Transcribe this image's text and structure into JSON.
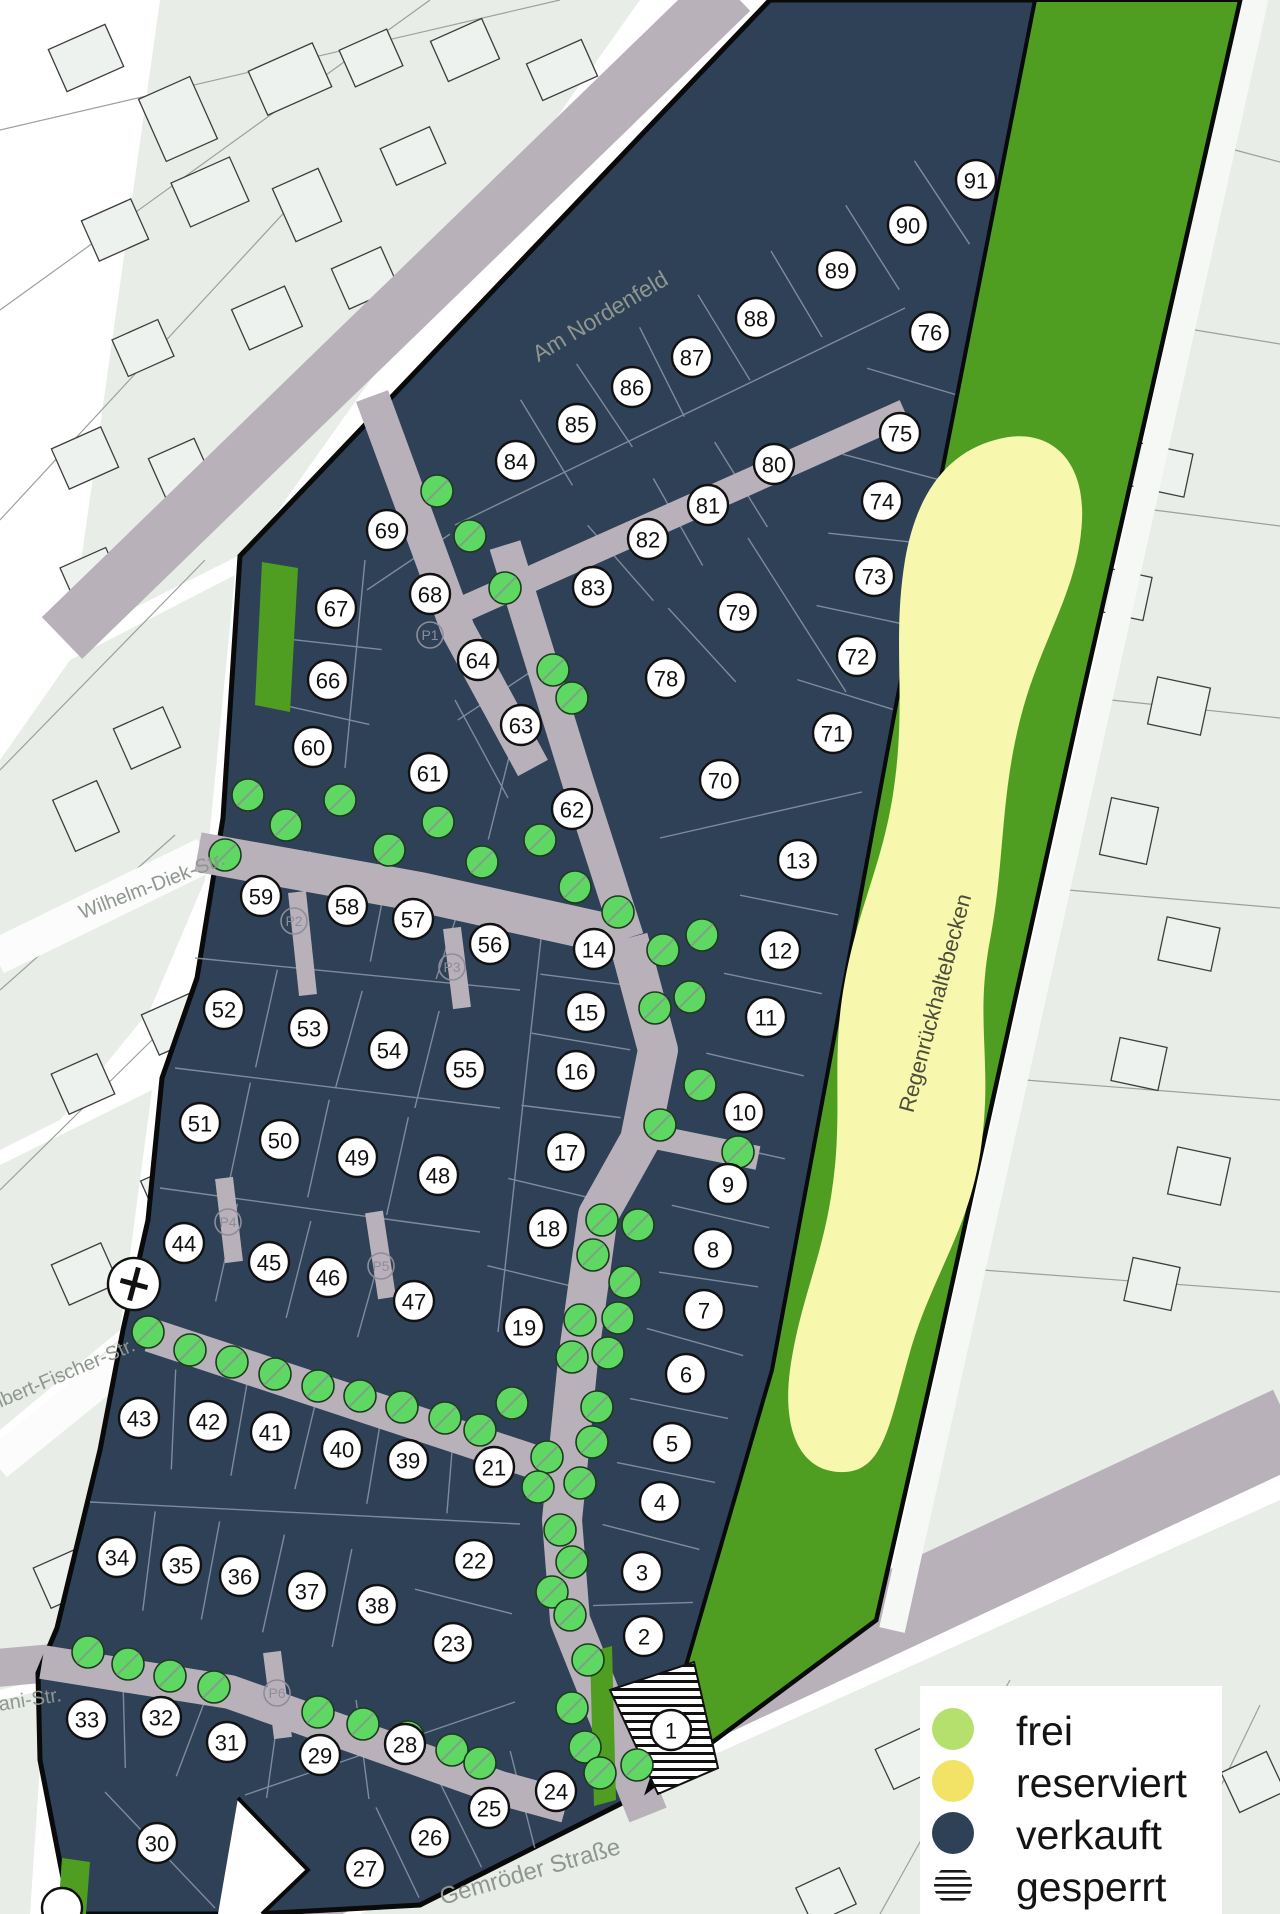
{
  "title": "Baugebiet Lageplan",
  "colors": {
    "sold": "#2e4156",
    "free": "#b5e06e",
    "reserved": "#f2e366",
    "blocked_stripes": "#111111",
    "green_area": "#4f9e22",
    "basin_yellow": "#f7f8ad",
    "street": "#b9b1ba",
    "tree": "#5fd763",
    "background_parcel": "#e8ede7",
    "boundary": "#0a0a0a"
  },
  "legend": {
    "items": [
      {
        "label": "frei",
        "swatch": "frei",
        "color": "#b5e06e"
      },
      {
        "label": "reserviert",
        "swatch": "reserviert",
        "color": "#f2e366"
      },
      {
        "label": "verkauft",
        "swatch": "verkauft",
        "color": "#2e4156"
      },
      {
        "label": "gesperrt",
        "swatch": "gesperrt",
        "color": "striped"
      }
    ]
  },
  "street_labels": [
    {
      "text": "Am Nordenfeld",
      "x": 600,
      "y": 316,
      "rot": -31,
      "size": 23
    },
    {
      "text": "Wilhelm-Diek-Str.",
      "x": 152,
      "y": 886,
      "rot": -21,
      "size": 20
    },
    {
      "text": "Albert-Fischer-Str.",
      "x": 60,
      "y": 1376,
      "rot": -23,
      "size": 20
    },
    {
      "text": "ani-Str.",
      "x": 30,
      "y": 1700,
      "rot": -9,
      "size": 20
    },
    {
      "text": "Gemröder Straße",
      "x": 530,
      "y": 1872,
      "rot": -16,
      "size": 24
    }
  ],
  "area_labels": [
    {
      "text": "Regenrückhaltebecken",
      "x": 935,
      "y": 1003,
      "rot": -75,
      "size": 22
    }
  ],
  "plots": [
    {
      "n": "91",
      "x": 976,
      "y": 180,
      "status": "verkauft"
    },
    {
      "n": "90",
      "x": 908,
      "y": 225,
      "status": "verkauft"
    },
    {
      "n": "89",
      "x": 837,
      "y": 270,
      "status": "verkauft"
    },
    {
      "n": "88",
      "x": 756,
      "y": 318,
      "status": "verkauft"
    },
    {
      "n": "87",
      "x": 692,
      "y": 357,
      "status": "verkauft"
    },
    {
      "n": "86",
      "x": 632,
      "y": 387,
      "status": "verkauft"
    },
    {
      "n": "85",
      "x": 577,
      "y": 424,
      "status": "verkauft"
    },
    {
      "n": "84",
      "x": 516,
      "y": 461,
      "status": "verkauft"
    },
    {
      "n": "76",
      "x": 930,
      "y": 332,
      "status": "verkauft"
    },
    {
      "n": "75",
      "x": 900,
      "y": 433,
      "status": "verkauft"
    },
    {
      "n": "74",
      "x": 882,
      "y": 501,
      "status": "verkauft"
    },
    {
      "n": "73",
      "x": 874,
      "y": 576,
      "status": "verkauft"
    },
    {
      "n": "72",
      "x": 857,
      "y": 656,
      "status": "verkauft"
    },
    {
      "n": "71",
      "x": 833,
      "y": 733,
      "status": "verkauft"
    },
    {
      "n": "80",
      "x": 774,
      "y": 464,
      "status": "verkauft"
    },
    {
      "n": "81",
      "x": 708,
      "y": 505,
      "status": "verkauft"
    },
    {
      "n": "82",
      "x": 648,
      "y": 539,
      "status": "verkauft"
    },
    {
      "n": "83",
      "x": 593,
      "y": 587,
      "status": "verkauft"
    },
    {
      "n": "79",
      "x": 738,
      "y": 612,
      "status": "verkauft"
    },
    {
      "n": "78",
      "x": 666,
      "y": 678,
      "status": "verkauft"
    },
    {
      "n": "70",
      "x": 720,
      "y": 780,
      "status": "verkauft"
    },
    {
      "n": "69",
      "x": 387,
      "y": 530,
      "status": "verkauft"
    },
    {
      "n": "68",
      "x": 430,
      "y": 594,
      "status": "verkauft"
    },
    {
      "n": "67",
      "x": 336,
      "y": 608,
      "status": "verkauft"
    },
    {
      "n": "66",
      "x": 328,
      "y": 680,
      "status": "verkauft"
    },
    {
      "n": "64",
      "x": 478,
      "y": 660,
      "status": "verkauft"
    },
    {
      "n": "63",
      "x": 521,
      "y": 725,
      "status": "verkauft"
    },
    {
      "n": "60",
      "x": 313,
      "y": 747,
      "status": "verkauft"
    },
    {
      "n": "61",
      "x": 429,
      "y": 773,
      "status": "verkauft"
    },
    {
      "n": "62",
      "x": 572,
      "y": 809,
      "status": "verkauft"
    },
    {
      "n": "13",
      "x": 798,
      "y": 860,
      "status": "verkauft"
    },
    {
      "n": "12",
      "x": 780,
      "y": 950,
      "status": "verkauft"
    },
    {
      "n": "11",
      "x": 766,
      "y": 1017,
      "status": "verkauft"
    },
    {
      "n": "59",
      "x": 261,
      "y": 896,
      "status": "verkauft"
    },
    {
      "n": "58",
      "x": 347,
      "y": 906,
      "status": "verkauft"
    },
    {
      "n": "57",
      "x": 413,
      "y": 919,
      "status": "verkauft"
    },
    {
      "n": "56",
      "x": 490,
      "y": 944,
      "status": "verkauft"
    },
    {
      "n": "14",
      "x": 594,
      "y": 949,
      "status": "verkauft"
    },
    {
      "n": "15",
      "x": 586,
      "y": 1012,
      "status": "verkauft"
    },
    {
      "n": "16",
      "x": 576,
      "y": 1071,
      "status": "verkauft"
    },
    {
      "n": "10",
      "x": 744,
      "y": 1112,
      "status": "verkauft"
    },
    {
      "n": "52",
      "x": 224,
      "y": 1009,
      "status": "verkauft"
    },
    {
      "n": "53",
      "x": 309,
      "y": 1028,
      "status": "verkauft"
    },
    {
      "n": "54",
      "x": 389,
      "y": 1050,
      "status": "verkauft"
    },
    {
      "n": "55",
      "x": 465,
      "y": 1069,
      "status": "verkauft"
    },
    {
      "n": "51",
      "x": 200,
      "y": 1123,
      "status": "verkauft"
    },
    {
      "n": "50",
      "x": 280,
      "y": 1140,
      "status": "verkauft"
    },
    {
      "n": "49",
      "x": 357,
      "y": 1157,
      "status": "verkauft"
    },
    {
      "n": "48",
      "x": 438,
      "y": 1175,
      "status": "verkauft"
    },
    {
      "n": "17",
      "x": 566,
      "y": 1152,
      "status": "verkauft"
    },
    {
      "n": "18",
      "x": 548,
      "y": 1228,
      "status": "verkauft"
    },
    {
      "n": "9",
      "x": 728,
      "y": 1184,
      "status": "verkauft"
    },
    {
      "n": "8",
      "x": 713,
      "y": 1249,
      "status": "verkauft"
    },
    {
      "n": "7",
      "x": 704,
      "y": 1310,
      "status": "verkauft"
    },
    {
      "n": "44",
      "x": 184,
      "y": 1243,
      "status": "verkauft"
    },
    {
      "n": "45",
      "x": 269,
      "y": 1262,
      "status": "verkauft"
    },
    {
      "n": "46",
      "x": 328,
      "y": 1277,
      "status": "verkauft"
    },
    {
      "n": "47",
      "x": 414,
      "y": 1301,
      "status": "verkauft"
    },
    {
      "n": "19",
      "x": 524,
      "y": 1327,
      "status": "verkauft"
    },
    {
      "n": "6",
      "x": 686,
      "y": 1374,
      "status": "verkauft"
    },
    {
      "n": "43",
      "x": 139,
      "y": 1418,
      "status": "verkauft"
    },
    {
      "n": "42",
      "x": 208,
      "y": 1421,
      "status": "verkauft"
    },
    {
      "n": "41",
      "x": 271,
      "y": 1432,
      "status": "verkauft"
    },
    {
      "n": "40",
      "x": 342,
      "y": 1449,
      "status": "verkauft"
    },
    {
      "n": "39",
      "x": 408,
      "y": 1460,
      "status": "verkauft"
    },
    {
      "n": "21",
      "x": 494,
      "y": 1467,
      "status": "verkauft"
    },
    {
      "n": "5",
      "x": 672,
      "y": 1443,
      "status": "verkauft"
    },
    {
      "n": "4",
      "x": 660,
      "y": 1502,
      "status": "verkauft"
    },
    {
      "n": "34",
      "x": 117,
      "y": 1557,
      "status": "verkauft"
    },
    {
      "n": "35",
      "x": 181,
      "y": 1565,
      "status": "verkauft"
    },
    {
      "n": "36",
      "x": 240,
      "y": 1576,
      "status": "verkauft"
    },
    {
      "n": "37",
      "x": 307,
      "y": 1591,
      "status": "verkauft"
    },
    {
      "n": "38",
      "x": 377,
      "y": 1605,
      "status": "verkauft"
    },
    {
      "n": "22",
      "x": 474,
      "y": 1560,
      "status": "verkauft"
    },
    {
      "n": "3",
      "x": 642,
      "y": 1572,
      "status": "verkauft"
    },
    {
      "n": "23",
      "x": 453,
      "y": 1643,
      "status": "verkauft"
    },
    {
      "n": "2",
      "x": 644,
      "y": 1636,
      "status": "verkauft"
    },
    {
      "n": "33",
      "x": 87,
      "y": 1719,
      "status": "verkauft"
    },
    {
      "n": "32",
      "x": 161,
      "y": 1717,
      "status": "verkauft"
    },
    {
      "n": "31",
      "x": 227,
      "y": 1742,
      "status": "verkauft"
    },
    {
      "n": "29",
      "x": 320,
      "y": 1755,
      "status": "verkauft"
    },
    {
      "n": "28",
      "x": 405,
      "y": 1744,
      "status": "verkauft"
    },
    {
      "n": "24",
      "x": 556,
      "y": 1791,
      "status": "verkauft"
    },
    {
      "n": "1",
      "x": 671,
      "y": 1730,
      "status": "gesperrt"
    },
    {
      "n": "30",
      "x": 157,
      "y": 1843,
      "status": "verkauft"
    },
    {
      "n": "25",
      "x": 489,
      "y": 1808,
      "status": "verkauft"
    },
    {
      "n": "26",
      "x": 430,
      "y": 1837,
      "status": "verkauft"
    },
    {
      "n": "27",
      "x": 365,
      "y": 1868,
      "status": "verkauft"
    }
  ],
  "partial_badges": [
    {
      "x": 62,
      "y": 1908
    }
  ],
  "parking": [
    {
      "label": "P1",
      "x": 430,
      "y": 635
    },
    {
      "label": "P2",
      "x": 294,
      "y": 921
    },
    {
      "label": "P3",
      "x": 452,
      "y": 967
    },
    {
      "label": "P4",
      "x": 228,
      "y": 1222
    },
    {
      "label": "P5",
      "x": 381,
      "y": 1266
    },
    {
      "label": "P6",
      "x": 277,
      "y": 1693
    }
  ],
  "markers": [
    {
      "type": "cross",
      "x": 134,
      "y": 1284
    }
  ],
  "trees": [
    [
      437,
      491
    ],
    [
      470,
      536
    ],
    [
      505,
      588
    ],
    [
      553,
      670
    ],
    [
      572,
      698
    ],
    [
      225,
      855
    ],
    [
      248,
      795
    ],
    [
      286,
      825
    ],
    [
      340,
      800
    ],
    [
      389,
      850
    ],
    [
      438,
      822
    ],
    [
      482,
      862
    ],
    [
      540,
      840
    ],
    [
      575,
      887
    ],
    [
      618,
      912
    ],
    [
      663,
      950
    ],
    [
      702,
      935
    ],
    [
      690,
      997
    ],
    [
      655,
      1008
    ],
    [
      700,
      1085
    ],
    [
      660,
      1125
    ],
    [
      738,
      1152
    ],
    [
      602,
      1220
    ],
    [
      638,
      1225
    ],
    [
      593,
      1255
    ],
    [
      625,
      1282
    ],
    [
      580,
      1320
    ],
    [
      618,
      1318
    ],
    [
      572,
      1357
    ],
    [
      608,
      1353
    ],
    [
      512,
      1403
    ],
    [
      597,
      1407
    ],
    [
      547,
      1457
    ],
    [
      592,
      1442
    ],
    [
      538,
      1487
    ],
    [
      580,
      1483
    ],
    [
      560,
      1530
    ],
    [
      572,
      1562
    ],
    [
      552,
      1592
    ],
    [
      570,
      1615
    ],
    [
      588,
      1660
    ],
    [
      572,
      1708
    ],
    [
      585,
      1747
    ],
    [
      600,
      1773
    ],
    [
      637,
      1765
    ],
    [
      148,
      1332
    ],
    [
      190,
      1350
    ],
    [
      232,
      1362
    ],
    [
      275,
      1374
    ],
    [
      318,
      1386
    ],
    [
      360,
      1396
    ],
    [
      402,
      1407
    ],
    [
      445,
      1418
    ],
    [
      480,
      1430
    ],
    [
      88,
      1652
    ],
    [
      128,
      1664
    ],
    [
      170,
      1676
    ],
    [
      214,
      1687
    ],
    [
      318,
      1712
    ],
    [
      363,
      1724
    ],
    [
      408,
      1737
    ],
    [
      452,
      1750
    ],
    [
      480,
      1763
    ]
  ],
  "parcel_rows": [
    [
      "84",
      "85",
      "86",
      "87",
      "88",
      "89",
      "90",
      "91"
    ],
    [
      "83",
      "82",
      "81",
      "80"
    ],
    [
      "76",
      "75",
      "74",
      "73",
      "72",
      "71"
    ],
    [
      "69",
      "68"
    ],
    [
      "67",
      "66",
      "60"
    ],
    [
      "64",
      "63"
    ],
    [
      "61",
      "62"
    ],
    [
      "78",
      "79"
    ],
    [
      "59",
      "58",
      "57",
      "56"
    ],
    [
      "52",
      "53",
      "54",
      "55"
    ],
    [
      "51",
      "50",
      "49",
      "48"
    ],
    [
      "44",
      "45",
      "46",
      "47"
    ],
    [
      "14",
      "15",
      "16",
      "17",
      "18",
      "19"
    ],
    [
      "13",
      "12",
      "11",
      "10",
      "9",
      "8",
      "7",
      "6",
      "5",
      "4",
      "3",
      "2"
    ],
    [
      "43",
      "42",
      "41",
      "40",
      "39",
      "21"
    ],
    [
      "34",
      "35",
      "36",
      "37",
      "38"
    ],
    [
      "22",
      "23"
    ],
    [
      "33",
      "32",
      "31",
      "29",
      "28"
    ],
    [
      "24",
      "25",
      "26",
      "27"
    ]
  ],
  "parcel_lines": [
    [
      455,
      525,
      905,
      308
    ],
    [
      748,
      538,
      846,
      692
    ],
    [
      660,
      838,
      862,
      792
    ],
    [
      545,
      902,
      498,
      1332
    ],
    [
      195,
      958,
      520,
      990
    ],
    [
      175,
      1068,
      500,
      1108
    ],
    [
      160,
      1188,
      480,
      1232
    ],
    [
      90,
      1502,
      520,
      1524
    ],
    [
      245,
      1795,
      515,
      1702
    ],
    [
      105,
      1792,
      215,
      1908
    ],
    [
      365,
      560,
      345,
      768
    ],
    [
      455,
      700,
      508,
      798
    ]
  ],
  "background": {
    "houses": [
      [
        55,
        35,
        62,
        46,
        -24
      ],
      [
        150,
        85,
        56,
        68,
        -24
      ],
      [
        255,
        55,
        70,
        48,
        -24
      ],
      [
        345,
        38,
        52,
        40,
        -24
      ],
      [
        437,
        28,
        56,
        44,
        -24
      ],
      [
        532,
        50,
        60,
        40,
        -24
      ],
      [
        178,
        168,
        64,
        48,
        -24
      ],
      [
        88,
        208,
        54,
        44,
        -24
      ],
      [
        282,
        176,
        50,
        58,
        -24
      ],
      [
        386,
        136,
        54,
        40,
        -24
      ],
      [
        238,
        296,
        58,
        44,
        -24
      ],
      [
        118,
        328,
        50,
        40,
        -24
      ],
      [
        338,
        256,
        54,
        44,
        -24
      ],
      [
        58,
        436,
        54,
        44,
        -24
      ],
      [
        158,
        446,
        50,
        58,
        -24
      ],
      [
        66,
        556,
        50,
        40,
        -24
      ],
      [
        120,
        716,
        54,
        44,
        -24
      ],
      [
        62,
        788,
        48,
        56,
        -24
      ],
      [
        148,
        1002,
        54,
        44,
        -24
      ],
      [
        58,
        1062,
        50,
        44,
        -24
      ],
      [
        148,
        1168,
        54,
        48,
        -24
      ],
      [
        58,
        1252,
        54,
        44,
        -24
      ],
      [
        118,
        1432,
        58,
        44,
        -24
      ],
      [
        40,
        1556,
        50,
        44,
        -24
      ],
      [
        1098,
        322,
        48,
        58,
        12
      ],
      [
        1135,
        448,
        54,
        44,
        12
      ],
      [
        1100,
        572,
        48,
        44,
        12
      ],
      [
        1152,
        682,
        54,
        48,
        12
      ],
      [
        1105,
        802,
        48,
        58,
        12
      ],
      [
        1162,
        922,
        54,
        44,
        12
      ],
      [
        1115,
        1042,
        48,
        44,
        12
      ],
      [
        1172,
        1152,
        54,
        48,
        12
      ],
      [
        1128,
        1262,
        48,
        44,
        12
      ],
      [
        882,
        1736,
        54,
        44,
        -25
      ],
      [
        962,
        1796,
        58,
        48,
        -25
      ],
      [
        1052,
        1856,
        54,
        44,
        -25
      ],
      [
        1148,
        1884,
        58,
        40,
        -25
      ],
      [
        802,
        1876,
        48,
        40,
        -25
      ],
      [
        1228,
        1760,
        50,
        44,
        -25
      ]
    ],
    "lines": [
      [
        0,
        130,
        560,
        0
      ],
      [
        0,
        310,
        430,
        0
      ],
      [
        0,
        520,
        305,
        190
      ],
      [
        95,
        640,
        365,
        335
      ],
      [
        0,
        770,
        205,
        560
      ],
      [
        0,
        990,
        175,
        835
      ],
      [
        0,
        1190,
        152,
        1040
      ],
      [
        1235,
        150,
        1280,
        162
      ],
      [
        1195,
        330,
        1280,
        344
      ],
      [
        1154,
        510,
        1280,
        526
      ],
      [
        1111,
        700,
        1280,
        718
      ],
      [
        1068,
        890,
        1280,
        908
      ],
      [
        1025,
        1080,
        1280,
        1100
      ],
      [
        982,
        1270,
        1280,
        1292
      ],
      [
        880,
        1914,
        1010,
        1680
      ],
      [
        1060,
        1880,
        1150,
        1700
      ],
      [
        1190,
        1850,
        1260,
        1705
      ]
    ]
  }
}
